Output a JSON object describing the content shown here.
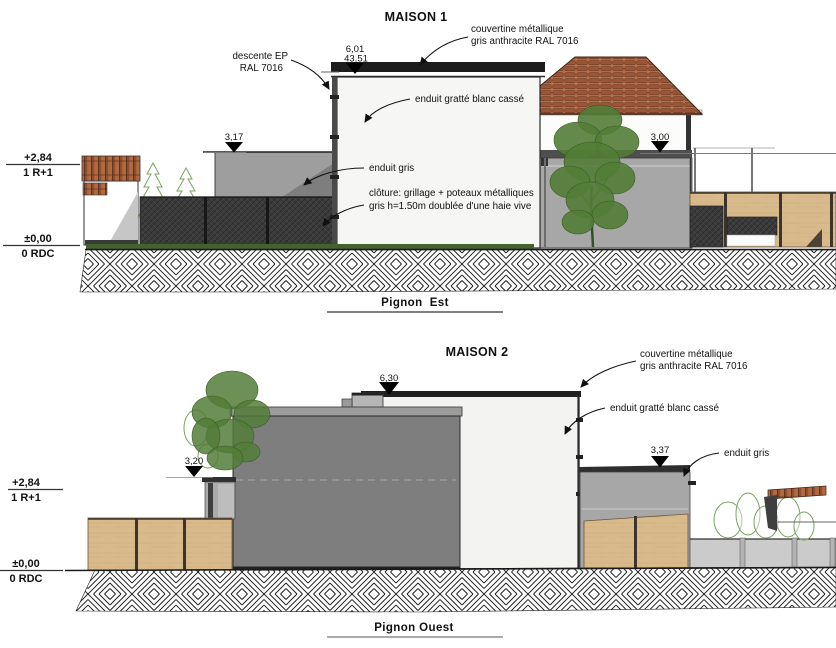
{
  "colors": {
    "white_wall": "#f6f6f4",
    "white_wall2": "#f3f3f1",
    "gray_wall": "#9e9e9e",
    "gray_wall_dark": "#7e7e7e",
    "gray_wall_light": "#a7a7a7",
    "dark_fence": "#3b3b3b",
    "wood_fence": "#d9ba8c",
    "roof_tile": "#9c5434",
    "foliage": "#527d37",
    "hedge_outline": "#7aa361",
    "low_wall": "#cbcbcb",
    "ink": "#1a1a1a"
  },
  "maison1": {
    "title": "MAISON 1",
    "caption": "Pignon  Est",
    "levels": {
      "upper_value": "+2,84",
      "upper_label": "1 R+1",
      "ground_value": "±0,00",
      "ground_label": "0 RDC"
    },
    "markers": {
      "ridge_height": "6,01",
      "ridge_elevation": "43,51",
      "wall_left": "3,17",
      "wall_right": "3,00"
    },
    "annotations": {
      "couvertine_1": "couvertine métallique",
      "couvertine_2": "gris anthracite RAL 7016",
      "descente_1": "descente EP",
      "descente_2": "RAL 7016",
      "enduit_blanc": "enduit gratté blanc cassé",
      "enduit_gris": "enduit gris",
      "cloture_1": "clôture: grillage + poteaux métalliques",
      "cloture_2": "gris h=1.50m doublée d'une haie vive"
    }
  },
  "maison2": {
    "title": "MAISON 2",
    "caption": "Pignon Ouest",
    "levels": {
      "upper_value": "+2,84",
      "upper_label": "1 R+1",
      "ground_value": "±0,00",
      "ground_label": "0 RDC"
    },
    "markers": {
      "ridge_height": "6,30",
      "wall_left": "3,20",
      "wall_right": "3,37"
    },
    "annotations": {
      "couvertine_1": "couvertine métallique",
      "couvertine_2": "gris anthracite RAL 7016",
      "enduit_blanc": "enduit gratté blanc cassé",
      "enduit_gris": "enduit gris"
    }
  }
}
